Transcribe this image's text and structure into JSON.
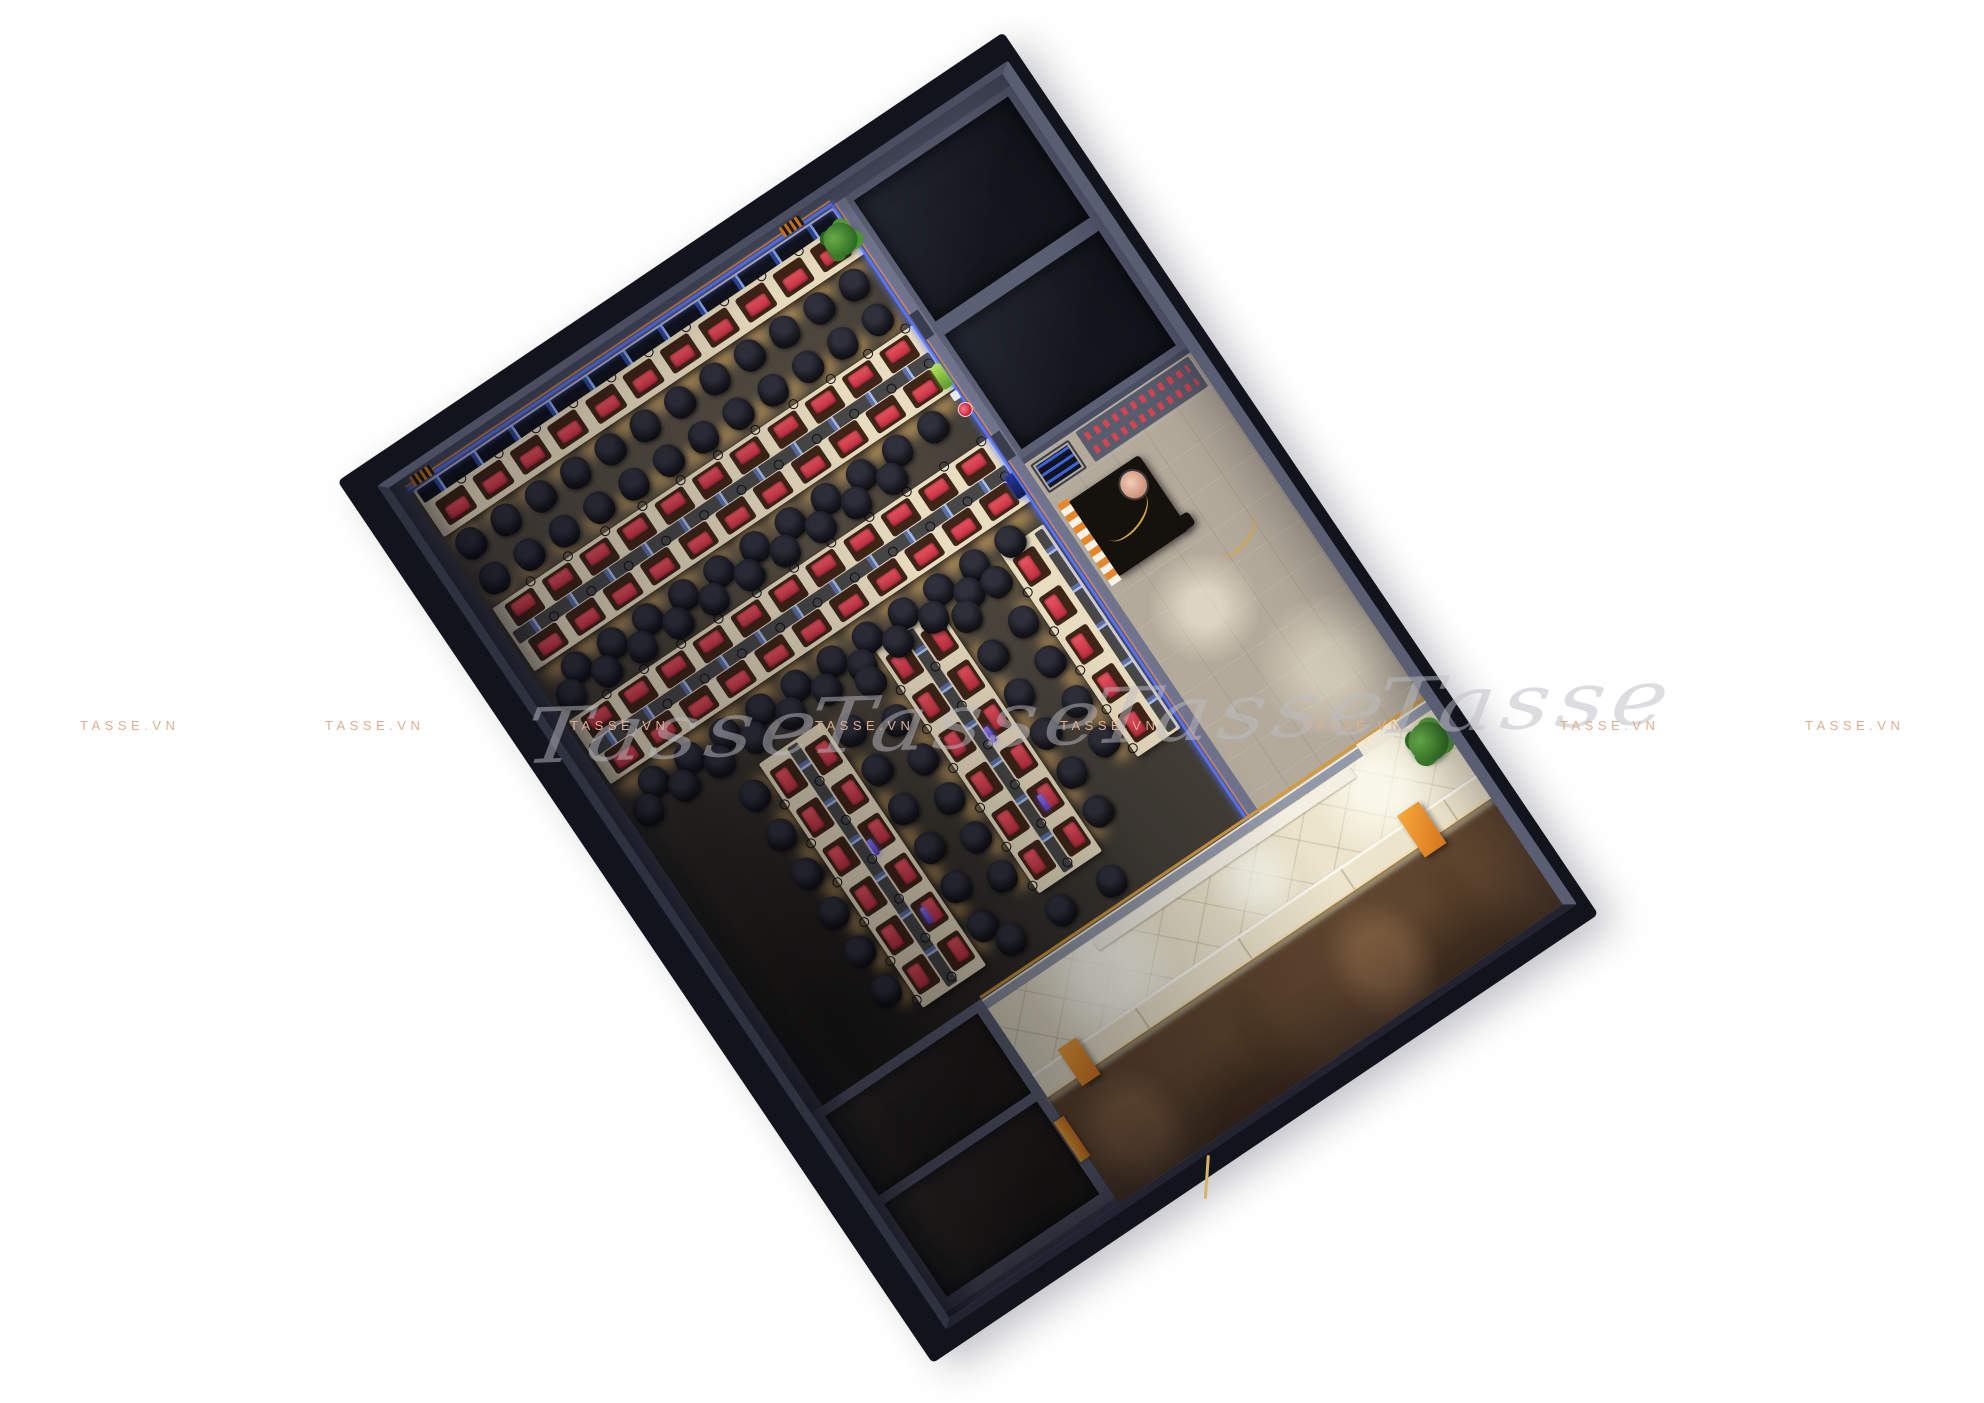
{
  "meta": {
    "title": "3D top-view interior render of a gaming cafe floor plan",
    "brand": "TASSE.VN",
    "background_color": "#ffffff"
  },
  "watermarks": {
    "caps_text": "TASSE.VN",
    "caps_color": "#dcae92",
    "caps_y": 718,
    "caps_x": [
      80,
      325,
      570,
      815,
      1060,
      1305,
      1560,
      1805
    ],
    "script_text": "Tasse",
    "script_color": "rgba(188,188,196,0.5)",
    "script_repeats": 4
  },
  "palette": {
    "shell_dark": "#12141d",
    "wall_gray": "#4b4f62",
    "hall_carpet": "#433e37",
    "desk_cream": "#e9ddc0",
    "pad_red": "#d23c4e",
    "chair_black": "#0d0d12",
    "accent_orange": "#e8872a",
    "led_blue": "#5b7bff",
    "lobby_cream": "#ece4cc",
    "terrace_brown": "#5e452f",
    "watermark_caps": "#dcae92",
    "watermark_script": "rgba(188,188,196,0.5)"
  },
  "building": {
    "x": 377,
    "y": 486,
    "width": 761,
    "height": 1018,
    "rotation_deg": -34,
    "regions": [
      "gaming-hall",
      "storage-room-1",
      "storage-room-2",
      "reception",
      "lobby-corridor",
      "restrooms",
      "storefront",
      "terrace"
    ]
  },
  "furniture": {
    "desk_rows": [
      {
        "id": "wall-row",
        "type": "wall",
        "x": 18,
        "y": 16,
        "w": 508,
        "h": 56,
        "stations": 11
      },
      {
        "id": "row-a",
        "type": "double-h",
        "x": 18,
        "y": 158,
        "w": 508,
        "h": 76,
        "stations": 11
      },
      {
        "id": "row-b",
        "type": "double-h",
        "x": 18,
        "y": 294,
        "w": 508,
        "h": 76,
        "stations": 11
      },
      {
        "id": "island-1",
        "type": "double-v",
        "x": 152,
        "y": 436,
        "w": 76,
        "h": 294,
        "stations": 6
      },
      {
        "id": "island-2",
        "type": "double-v",
        "x": 312,
        "y": 406,
        "w": 76,
        "h": 294,
        "stations": 6
      },
      {
        "id": "side-row",
        "type": "single-v",
        "x": 470,
        "y": 396,
        "w": 52,
        "h": 246,
        "stations": 5
      }
    ],
    "chair_rows": [
      {
        "x": 22,
        "y": 76,
        "count": 12,
        "dx": 42,
        "dy": 0
      },
      {
        "x": 22,
        "y": 118,
        "count": 12,
        "dx": 42,
        "dy": 0
      },
      {
        "x": 40,
        "y": 238,
        "count": 11,
        "dx": 43,
        "dy": 0
      },
      {
        "x": 20,
        "y": 258,
        "count": 10,
        "dx": 43,
        "dy": 0
      },
      {
        "x": 40,
        "y": 376,
        "count": 11,
        "dx": 43,
        "dy": 0
      },
      {
        "x": 20,
        "y": 396,
        "count": 10,
        "dx": 43,
        "dy": 0
      },
      {
        "x": 116,
        "y": 444,
        "count": 6,
        "dx": 0,
        "dy": 47
      },
      {
        "x": 232,
        "y": 444,
        "count": 6,
        "dx": 0,
        "dy": 47
      },
      {
        "x": 276,
        "y": 414,
        "count": 6,
        "dx": 0,
        "dy": 47
      },
      {
        "x": 392,
        "y": 414,
        "count": 6,
        "dx": 0,
        "dy": 47
      },
      {
        "x": 436,
        "y": 402,
        "count": 5,
        "dx": 0,
        "dy": 48
      },
      {
        "x": 248,
        "y": 706,
        "count": 3,
        "dx": 58,
        "dy": 4
      }
    ],
    "glow_strips": [
      {
        "x": 18,
        "y": 70,
        "w": 508,
        "h": 20,
        "o": "h"
      },
      {
        "x": 18,
        "y": 136,
        "w": 508,
        "h": 18,
        "o": "h"
      },
      {
        "x": 18,
        "y": 232,
        "w": 508,
        "h": 20,
        "o": "h"
      },
      {
        "x": 18,
        "y": 368,
        "w": 508,
        "h": 20,
        "o": "h"
      },
      {
        "x": 136,
        "y": 440,
        "w": 16,
        "h": 288,
        "o": "v"
      },
      {
        "x": 228,
        "y": 440,
        "w": 16,
        "h": 288,
        "o": "v"
      },
      {
        "x": 296,
        "y": 410,
        "w": 16,
        "h": 288,
        "o": "v"
      },
      {
        "x": 388,
        "y": 410,
        "w": 16,
        "h": 288,
        "o": "v"
      },
      {
        "x": 452,
        "y": 400,
        "w": 16,
        "h": 240,
        "o": "v"
      }
    ],
    "purple_monitors": [
      {
        "x": 198,
        "y": 560
      },
      {
        "x": 204,
        "y": 646
      },
      {
        "x": 358,
        "y": 532
      },
      {
        "x": 364,
        "y": 618
      }
    ]
  }
}
